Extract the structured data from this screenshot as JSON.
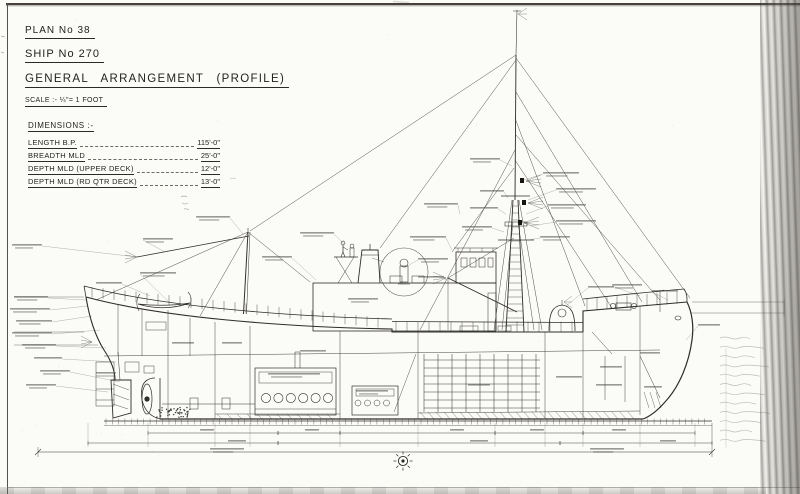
{
  "sheet": {
    "title_block": {
      "plan_no": "PLAN No 38",
      "ship_no": "SHIP No 270",
      "title": "GENERAL ARRANGEMENT (PROFILE)",
      "scale": "SCALE :- ¼\"= 1 FOOT"
    },
    "dimensions": {
      "heading": "DIMENSIONS :-",
      "rows": [
        {
          "label": "LENGTH B.P.",
          "value": "115'-0\""
        },
        {
          "label": "BREADTH MLD",
          "value": "25'-0\""
        },
        {
          "label": "DEPTH MLD (UPPER DECK)",
          "value": "12'-0\""
        },
        {
          "label": "DEPTH MLD (RD QTR DECK)",
          "value": "13'-0\""
        }
      ]
    },
    "colors": {
      "ink": "#2f2d2a",
      "paper": "#fbfbf8",
      "pencil": "#8f8b84"
    }
  }
}
